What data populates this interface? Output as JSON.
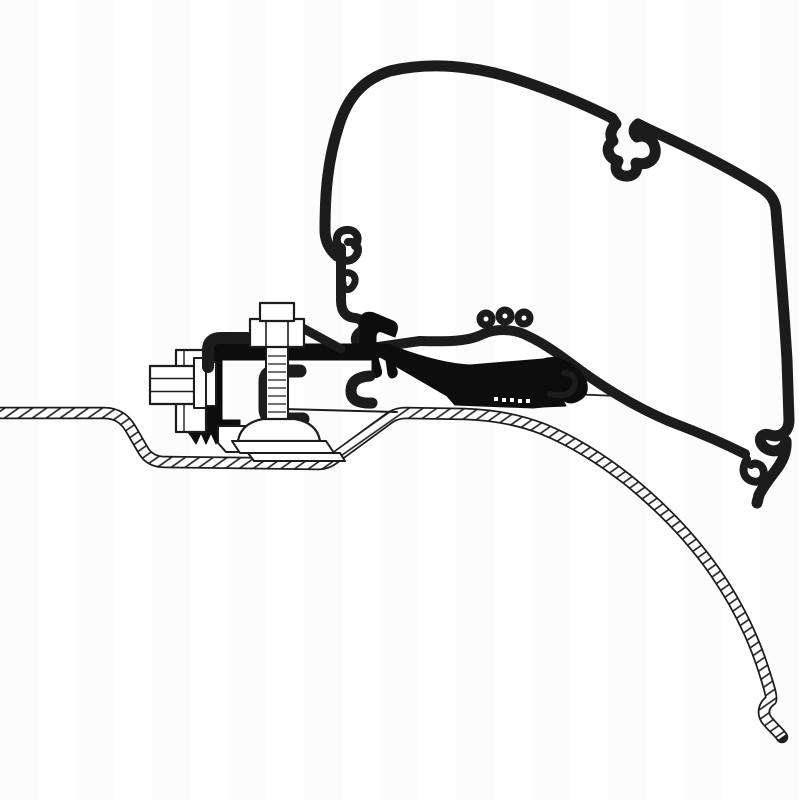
{
  "page": {
    "kind": "technical-line-drawing",
    "background_color": "#ffffff",
    "line_color": "#1c1c1c",
    "black_fill_color": "#0d0d0d"
  },
  "drawing": {
    "title": "Awning adapter bracket cross-section on van roof",
    "description": "Monochrome outline illustration: black adapter profile bolted to a clamp bracket on a hatched van roof sheet, carrying the hollow awning case profile and its mounting rail",
    "components": [
      {
        "id": "awning-case-profile",
        "label": "Awning case outer profile (hollow outline arc)"
      },
      {
        "id": "case-top-notch",
        "label": "C-shaped curl notch on case upper edge"
      },
      {
        "id": "case-bottom-hooks",
        "label": "C-hook channel and lower hook at case bottom right"
      },
      {
        "id": "mounting-rail",
        "label": "Case mounting rail profile descending to the right"
      },
      {
        "id": "rail-antler-ribs",
        "label": "Small rib curls on top of mounting rail"
      },
      {
        "id": "rail-interlock",
        "label": "Hook interlock between case bottom and rail top"
      },
      {
        "id": "adapter-profile",
        "label": "Black adapter profile with claw, diagonal web, foot and J-hook"
      },
      {
        "id": "serrated-foot",
        "label": "Serrated clamping foot of adapter"
      },
      {
        "id": "vertical-bolt",
        "label": "Vertical clamp bolt with square head and hex nut"
      },
      {
        "id": "horizontal-bolt",
        "label": "Horizontal hex bolt through bracket upright"
      },
      {
        "id": "c-clamp",
        "label": "C-shaped clamp piece around bolt"
      },
      {
        "id": "dome-washer",
        "label": "Domed washer and foot plates under bolt"
      },
      {
        "id": "roof-sheet",
        "label": "Hatched van roof sheet with recessed channel, curving down at right"
      }
    ]
  }
}
